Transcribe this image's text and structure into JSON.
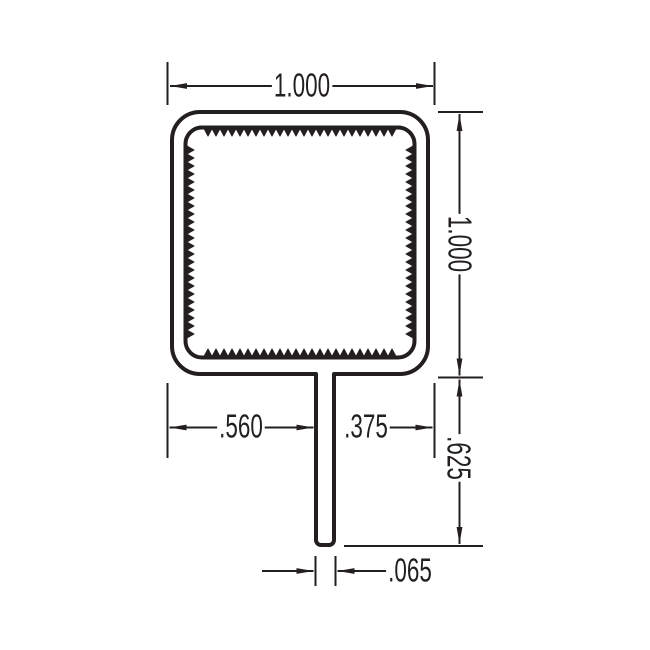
{
  "drawing": {
    "type": "extrusion-profile-cross-section",
    "line_color": "#231f20",
    "background": "#ffffff",
    "labels": {
      "overall_width": "1.000",
      "overall_height": "1.000",
      "stem_offset_left": ".560",
      "stem_offset_right": ".375",
      "stem_length": ".625",
      "stem_thickness": ".065"
    }
  }
}
